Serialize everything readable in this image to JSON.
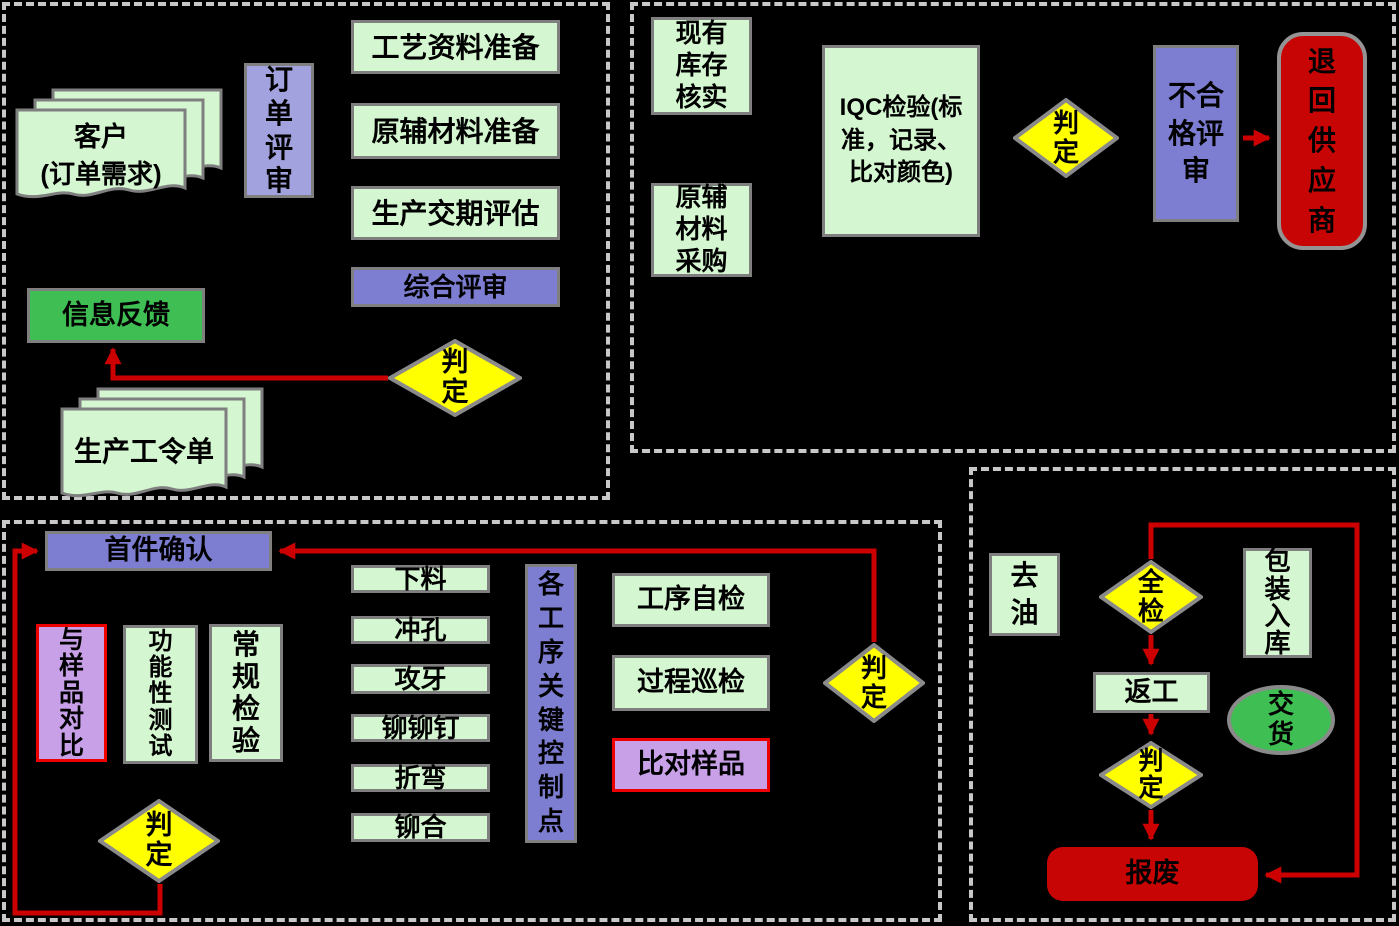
{
  "colors": {
    "background": "#000000",
    "node_green": "#d4f6d0",
    "node_purple": "#7d7dd2",
    "node_light_purple": "#a2a2de",
    "node_bright_green": "#3fbf53",
    "node_pink": "#c8a0e8",
    "node_red": "#c80505",
    "diamond_yellow": "#ffff00",
    "arrow_red": "#cc0000",
    "section_border": "#c8c8c8"
  },
  "order_review": {
    "customer_doc_line1": "客户",
    "customer_doc_line2": "(订单需求)",
    "order_review": "订单评审",
    "process_prep": "工艺资料准备",
    "material_prep": "原辅材料准备",
    "delivery_eval": "生产交期评估",
    "comprehensive_review": "综合评审",
    "judgment": "判定",
    "info_feedback": "信息反馈",
    "work_order": "生产工令单"
  },
  "incoming_material": {
    "stock_verify": "现有库存核实",
    "material_purchase": "原辅材料采购",
    "iqc_inspection": "IQC检验(标准，记录、比对颜色)",
    "judgment": "判定",
    "nonconforming_review": "不合格评审",
    "return_to_supplier": "退回供应商"
  },
  "production": {
    "first_article_confirm": "首件确认",
    "compare_with_sample": "与样品对比",
    "functional_test": "功能性测试",
    "routine_inspection": "常规检验",
    "process_steps": [
      "下料",
      "冲孔",
      "攻牙",
      "铆铆钉",
      "折弯",
      "铆合"
    ],
    "key_control_points": "各工序关键控制点",
    "process_self_check": "工序自检",
    "process_patrol_check": "过程巡检",
    "compare_sample": "比对样品",
    "judgment_right": "判定",
    "judgment_bottom": "判定"
  },
  "finishing": {
    "degrease": "去油",
    "full_inspection": "全检",
    "packing_storage": "包装入库",
    "rework": "返工",
    "delivery": "交货",
    "judgment": "判定",
    "scrap": "报废"
  }
}
